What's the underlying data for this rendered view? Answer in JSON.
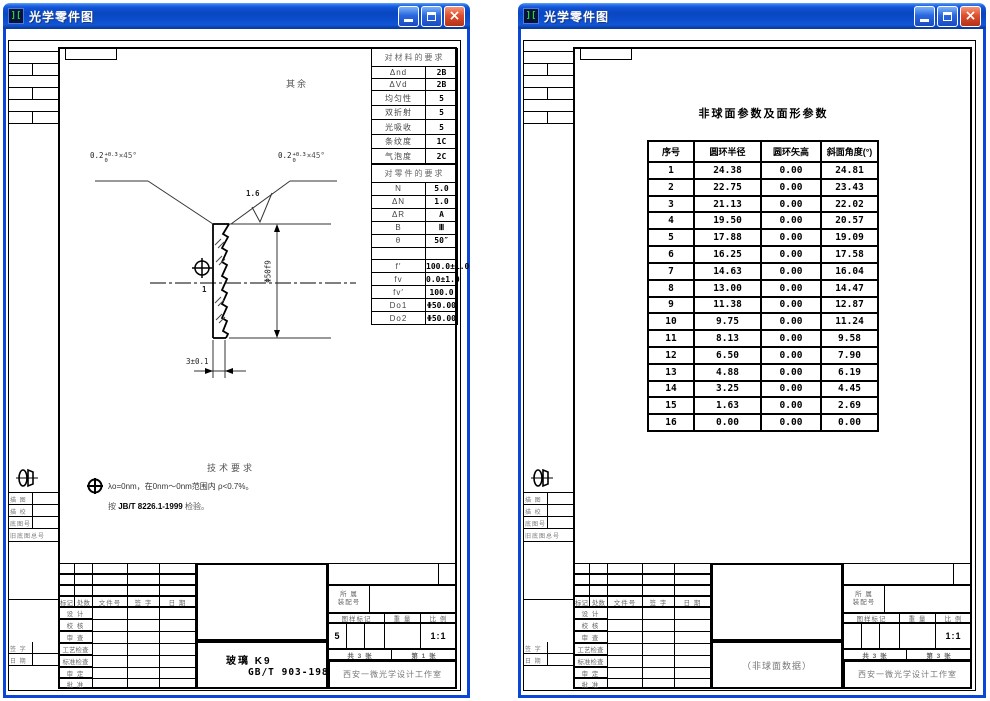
{
  "app": {
    "title": "光学零件图",
    "close_glyph": "×"
  },
  "margin": {
    "labels": [
      "描 图",
      "描 校",
      "底图号",
      "旧底图总号",
      "签 字",
      "日 期"
    ]
  },
  "title_block": {
    "headers": [
      "标记",
      "处数",
      "文件号",
      "签 字",
      "日 期"
    ],
    "labels": [
      "设 计",
      "校 核",
      "审 查",
      "工艺检查",
      "标准检查",
      "审 定",
      "批 准"
    ],
    "assembly_l1": "所 属",
    "assembly_l2": "装配号",
    "mark_h": "图样标记",
    "weight_h": "重 量",
    "scale_h": "比 例",
    "total": "共 3 张",
    "company": "西安一微光学设计工作室"
  },
  "left": {
    "misc": "其余",
    "chamfer": {
      "base": "0.2",
      "sup": "+0.3",
      "sub": "0",
      "angle": "×45°"
    },
    "finish": "1.6",
    "datum": "1",
    "diameter": "Φ50f9",
    "thickness": "3±0.1",
    "material_table": {
      "title": "对材料的要求",
      "rows": [
        [
          "Δnd",
          "2B"
        ],
        [
          "ΔVd",
          "2B"
        ],
        [
          "均匀性",
          "5"
        ],
        [
          "双折射",
          "5"
        ],
        [
          "光吸收",
          "5"
        ],
        [
          "条纹度",
          "1C"
        ],
        [
          "气泡度",
          "2C"
        ]
      ]
    },
    "part_table": {
      "title": "对零件的要求",
      "rows": [
        [
          "N",
          "5.0"
        ],
        [
          "ΔN",
          "1.0"
        ],
        [
          "ΔR",
          "A"
        ],
        [
          "B",
          "Ⅲ"
        ],
        [
          "θ",
          "50″"
        ],
        [
          " ",
          " "
        ],
        [
          "f′",
          "100.0±1.0"
        ],
        [
          "fv",
          "0.0±1.0"
        ],
        [
          "fv′",
          "100.0"
        ],
        [
          "Do1",
          "Φ50.00"
        ],
        [
          "Do2",
          "Φ50.00"
        ]
      ]
    },
    "tech": {
      "title": "技术要求",
      "line1": "λo=0nm，在0nm～0nm范围内 ρ<0.7%。",
      "line2_pre": "按 ",
      "line2_std": "JB/T 8226.1-1999",
      "line2_post": " 检验。"
    },
    "block": {
      "material": "玻璃  K9",
      "standard": "GB/T 903-1987",
      "mark_v": "5",
      "scale": "1:1",
      "page": "第 1 张"
    }
  },
  "right": {
    "table_title": "非球面参数及面形参数",
    "table": {
      "headers": [
        "序号",
        "圆环半径",
        "圆环矢高",
        "斜面角度(°)"
      ],
      "rows": [
        [
          "1",
          "24.38",
          "0.00",
          "24.81"
        ],
        [
          "2",
          "22.75",
          "0.00",
          "23.43"
        ],
        [
          "3",
          "21.13",
          "0.00",
          "22.02"
        ],
        [
          "4",
          "19.50",
          "0.00",
          "20.57"
        ],
        [
          "5",
          "17.88",
          "0.00",
          "19.09"
        ],
        [
          "6",
          "16.25",
          "0.00",
          "17.58"
        ],
        [
          "7",
          "14.63",
          "0.00",
          "16.04"
        ],
        [
          "8",
          "13.00",
          "0.00",
          "14.47"
        ],
        [
          "9",
          "11.38",
          "0.00",
          "12.87"
        ],
        [
          "10",
          "9.75",
          "0.00",
          "11.24"
        ],
        [
          "11",
          "8.13",
          "0.00",
          "9.58"
        ],
        [
          "12",
          "6.50",
          "0.00",
          "7.90"
        ],
        [
          "13",
          "4.88",
          "0.00",
          "6.19"
        ],
        [
          "14",
          "3.25",
          "0.00",
          "4.45"
        ],
        [
          "15",
          "1.63",
          "0.00",
          "2.69"
        ],
        [
          "16",
          "0.00",
          "0.00",
          "0.00"
        ]
      ]
    },
    "block": {
      "center": "（非球面数据）",
      "mark_v": "",
      "scale": "1:1",
      "page": "第 3 张"
    }
  }
}
